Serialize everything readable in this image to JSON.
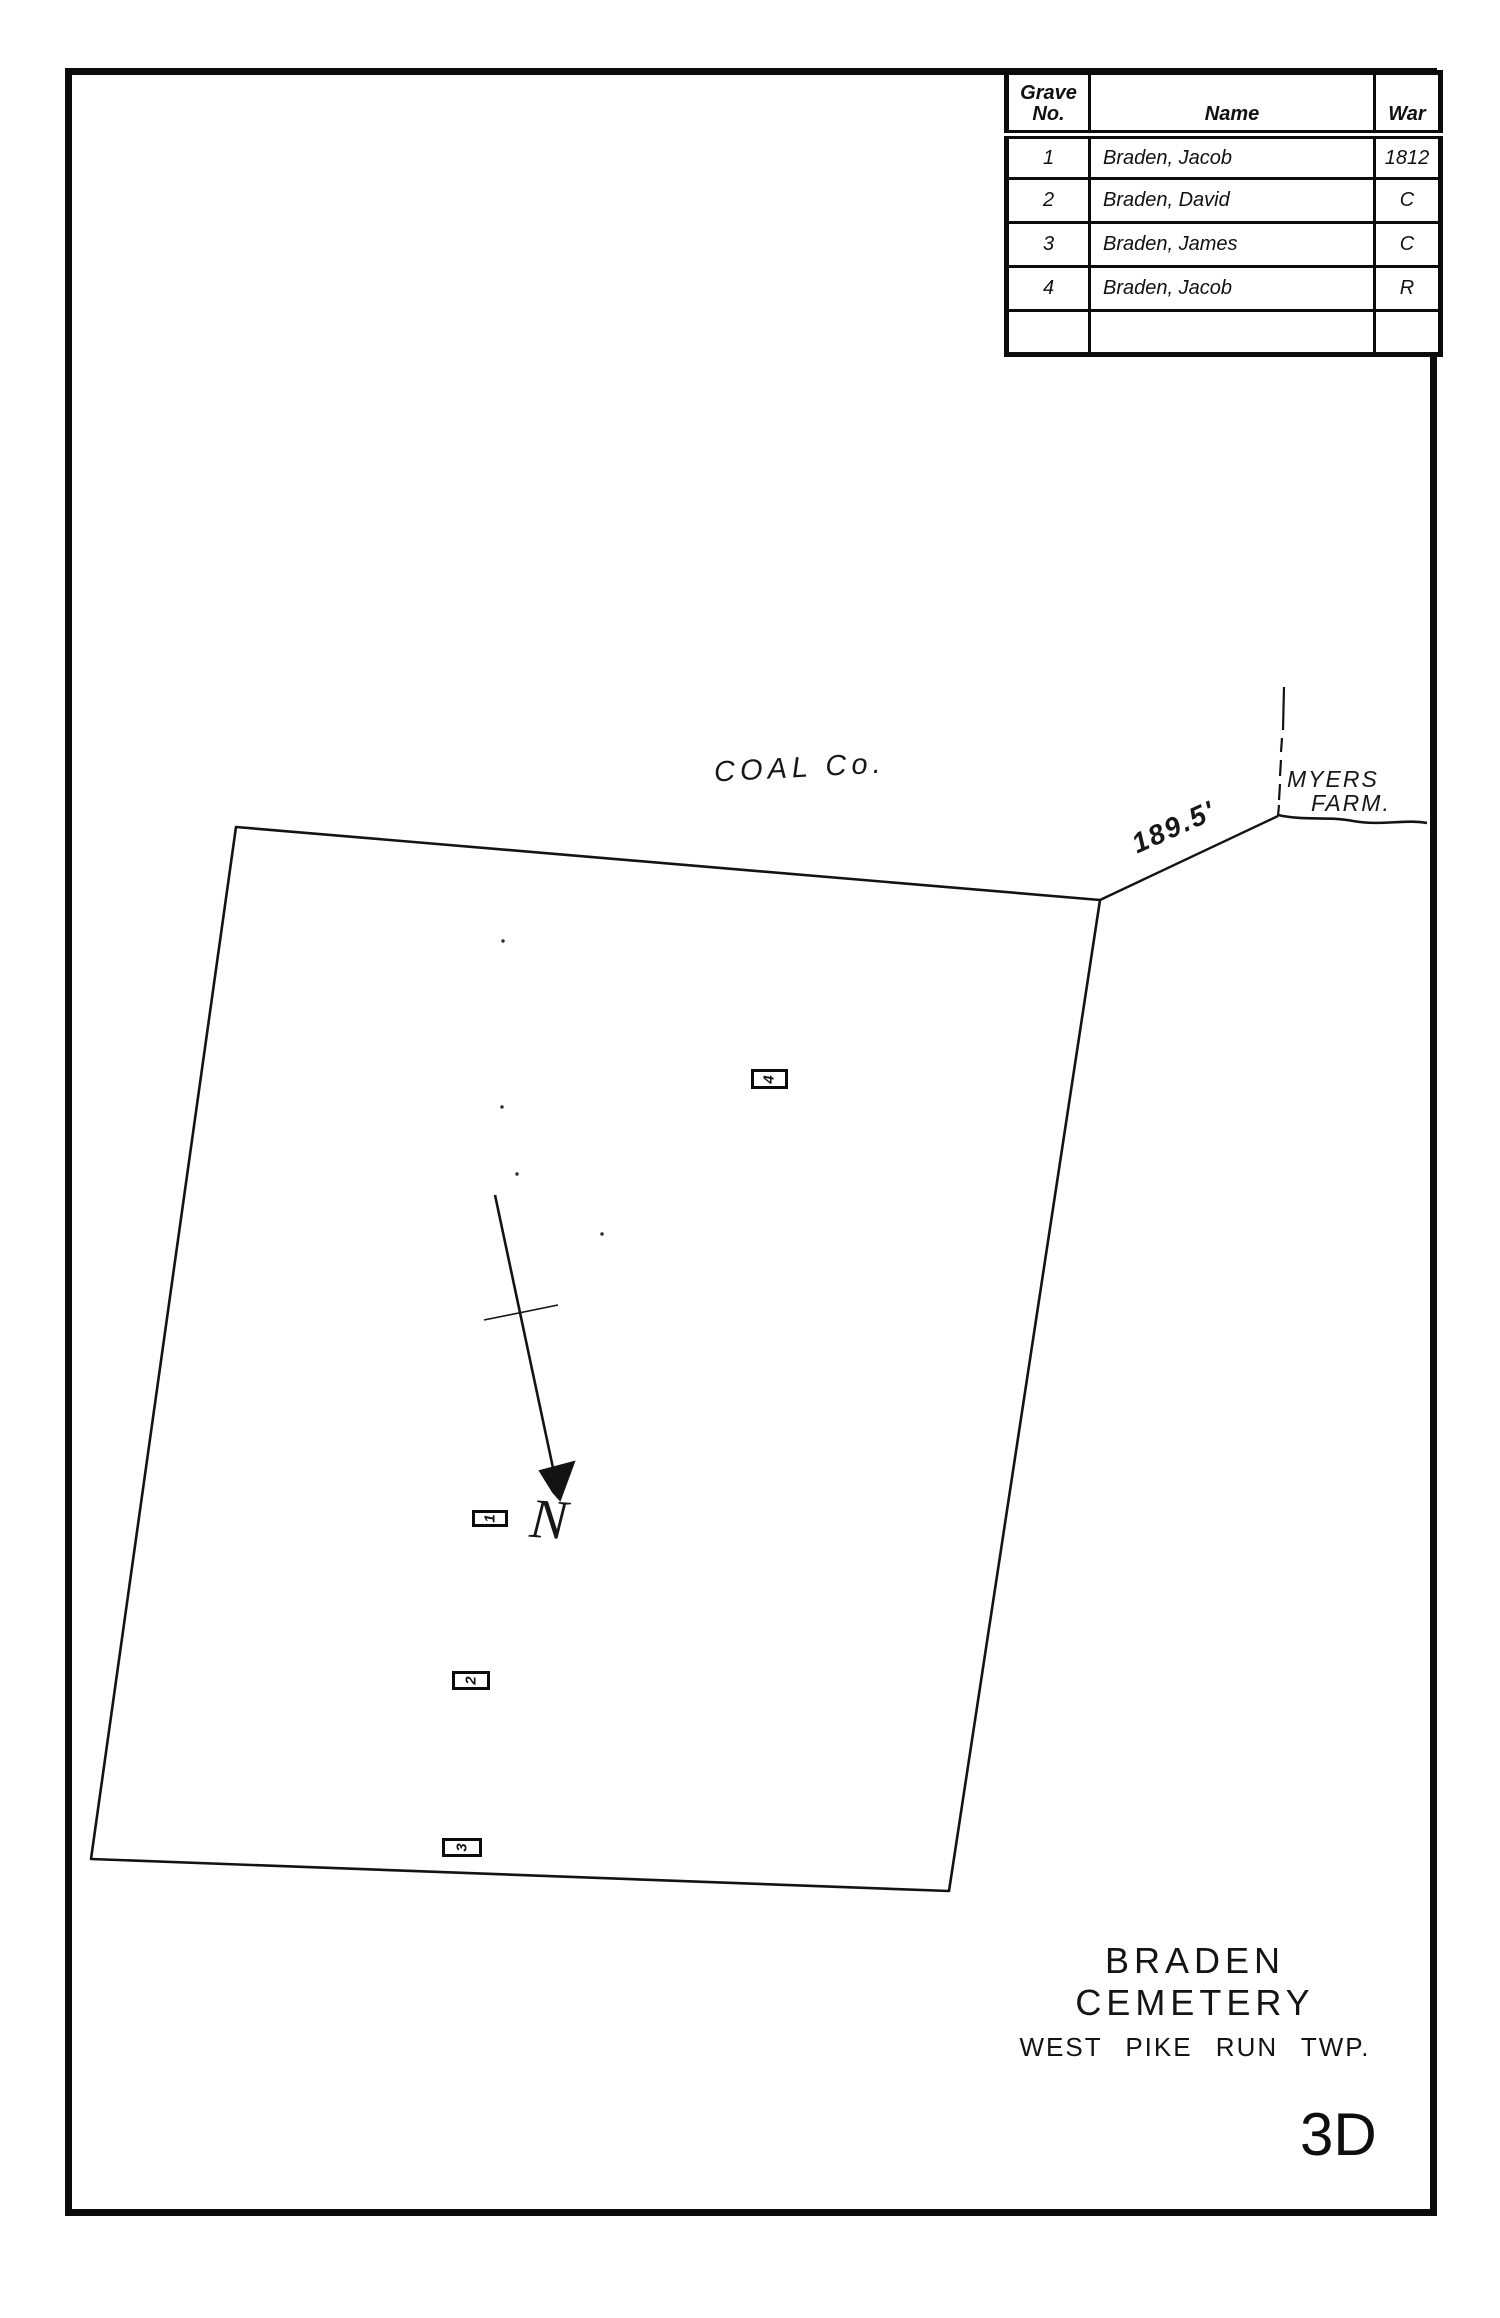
{
  "ink_color": "#111111",
  "paper_color": "#ffffff",
  "grave_table": {
    "headers": {
      "grave_no_line1": "Grave",
      "grave_no_line2": "No.",
      "name": "Name",
      "war": "War"
    },
    "rows": [
      {
        "no": "1",
        "name": "Braden, Jacob",
        "war": "1812"
      },
      {
        "no": "2",
        "name": "Braden, David",
        "war": "C"
      },
      {
        "no": "3",
        "name": "Braden, James",
        "war": "C"
      },
      {
        "no": "4",
        "name": "Braden, Jacob",
        "war": "R"
      },
      {
        "no": "",
        "name": "",
        "war": ""
      }
    ]
  },
  "map": {
    "neighbor_top_label": "COAL Co.",
    "neighbor_right_label_line1": "MYERS",
    "neighbor_right_label_line2": "FARM.",
    "boundary_distance_label": "189.5'",
    "north_label": "N",
    "markers": [
      {
        "number": "4"
      },
      {
        "number": "1"
      },
      {
        "number": "2"
      },
      {
        "number": "3"
      }
    ]
  },
  "title_block": {
    "cemetery_name": "BRADEN  CEMETERY",
    "township": "WEST PIKE RUN TWP.",
    "sheet_number": "3D"
  }
}
